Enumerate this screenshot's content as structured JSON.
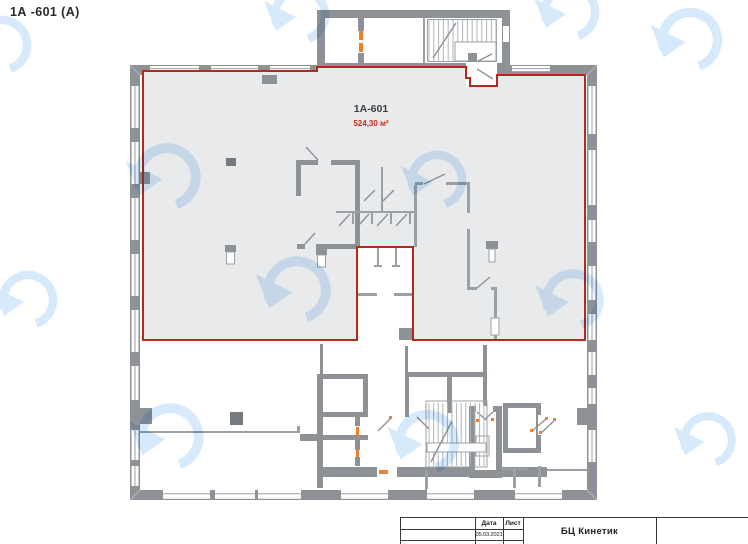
{
  "page": {
    "header_title": "1А -601  (А)"
  },
  "unit": {
    "name": "1А-601",
    "area": "524,30 м²"
  },
  "title_block": {
    "col_date": "Дата",
    "col_sheet": "Лист",
    "date": "05.03.2021",
    "project": "БЦ Кинетик"
  },
  "icons": {
    "watermark": "timer-clock-logo"
  },
  "colors": {
    "wall": "#8e9296",
    "wall_dark": "#6f7478",
    "partition": "#9aa0a5",
    "unit_fill": "#e9eaeb",
    "unit_outline": "#b32a1c",
    "area_text": "#cb2c20",
    "door_marker": "#ee7f2d",
    "watermark": "#d7eafc",
    "title_lines": "#3a3a3a"
  }
}
